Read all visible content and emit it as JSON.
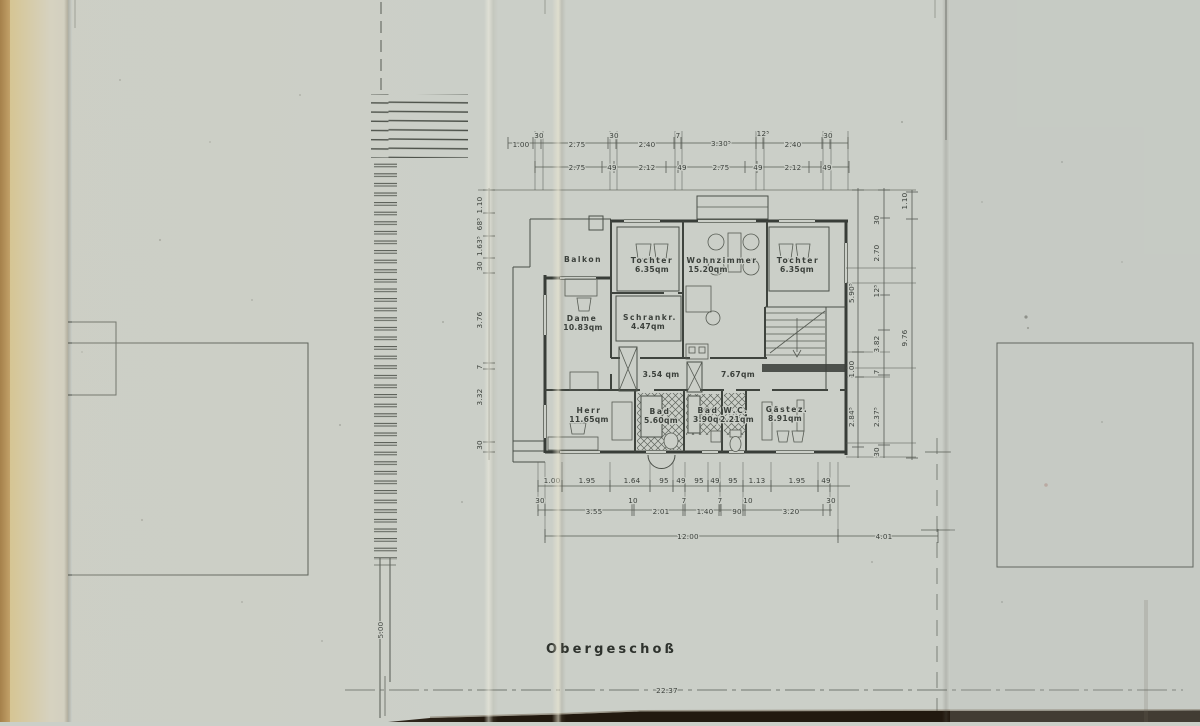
{
  "title": "Obergeschoß",
  "colors": {
    "paper": "#cbcfc8",
    "ink": "#3c413c",
    "edge_tan": "#a5804a",
    "scan_edge": "#22190f"
  },
  "rooms": {
    "balkon": {
      "name": "Balkon"
    },
    "tochter1": {
      "name": "Tochter",
      "area": "6.35qm"
    },
    "wohnzimmer": {
      "name": "Wohnzimmer",
      "area": "15.20qm"
    },
    "tochter2": {
      "name": "Tochter",
      "area": "6.35qm"
    },
    "dame": {
      "name": "Dame",
      "area": "10.83qm"
    },
    "schrank": {
      "name": "Schrankr.",
      "area": "4.47qm"
    },
    "flur1": {
      "area": "3.54 qm"
    },
    "flur2": {
      "area": "7.67qm"
    },
    "herr": {
      "name": "Herr",
      "area": "11.65qm"
    },
    "bad1": {
      "name": "Bad",
      "area": "5.60qm"
    },
    "bad2": {
      "name": "Bad",
      "area": "3.90qm"
    },
    "wc": {
      "name": "W.C.",
      "area": "2.21qm"
    },
    "gaestez": {
      "name": "Gästez.",
      "area": "8.91qm"
    }
  },
  "dims": {
    "top1": [
      "1.00",
      "30",
      "2.75",
      "30",
      "2.40",
      "7",
      "3.30⁵",
      "12⁵",
      "2.40",
      "30"
    ],
    "top2": [
      "2.75",
      "49",
      "2.12",
      "49",
      "2.75",
      "49",
      "2.12",
      "49"
    ],
    "left": [
      "1.10",
      "68⁵",
      "1.63⁵",
      "30",
      "3.76",
      "7",
      "3.32",
      "30"
    ],
    "right_inner": [
      "5.90⁵",
      "1.00",
      "2.84⁵"
    ],
    "right_mid": [
      "30",
      "2.70",
      "12⁵",
      "3.82",
      "7",
      "2.37⁵",
      "30"
    ],
    "right_outer": [
      "1.10",
      "9.76"
    ],
    "bottom1": [
      "1.00",
      "1.95",
      "1.64",
      "95",
      "49",
      "95",
      "49",
      "95",
      "1.13",
      "1.95",
      "49"
    ],
    "bottom2": [
      "30",
      "3.55",
      "10",
      "2.01",
      "7",
      "1.40",
      "7",
      "90",
      "10",
      "3.20",
      "30"
    ],
    "bottom3": [
      "12.00",
      "4.01"
    ],
    "left_lower": "5.00",
    "overall": "22.37"
  }
}
